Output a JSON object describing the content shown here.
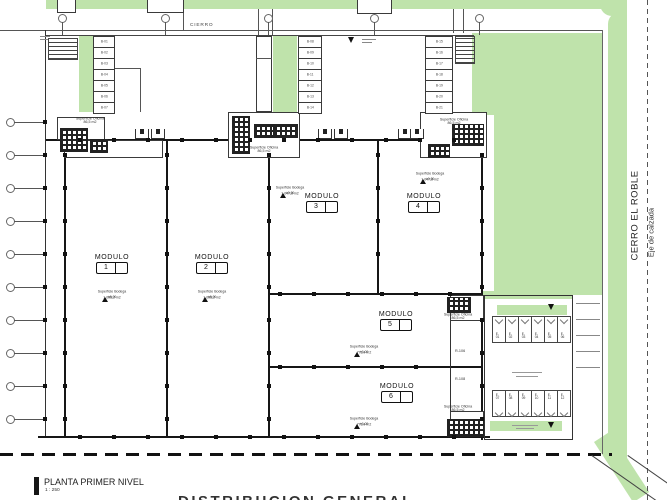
{
  "header": {
    "fence_label": "CIERRO"
  },
  "right_margin": {
    "street": "CERRO EL ROBLE",
    "axis": "Eje de calzada"
  },
  "title_block": {
    "title": "PLANTA PRIMER NIVEL",
    "scale": "1 : 250"
  },
  "footer_title": "DISTRIBUCION GENERAL",
  "levels": {
    "mark": "±0,00"
  },
  "office_label": {
    "line1": "Superficie Oficina",
    "line2": "86,5 m2"
  },
  "modules": [
    {
      "label": "MODULO",
      "num": "1",
      "sup": "Superficie Bodega",
      "area": "1.095,2 m2"
    },
    {
      "label": "MODULO",
      "num": "2",
      "sup": "Superficie Bodega",
      "area": "1.095,2 m2"
    },
    {
      "label": "MODULO",
      "num": "3",
      "sup": "Superficie Bodega",
      "area": "1.047,6 m2"
    },
    {
      "label": "MODULO",
      "num": "4",
      "sup": "Superficie Bodega",
      "area": "1.047,6 m2"
    },
    {
      "label": "MODULO",
      "num": "5",
      "sup": "Superficie Bodega",
      "area": "772,4 m2"
    },
    {
      "label": "MODULO",
      "num": "6",
      "sup": "Superficie Bodega",
      "area": "772,4 m2"
    }
  ],
  "room_stacks": {
    "left": [
      "B-01",
      "B-02",
      "B-03",
      "B-04",
      "B-05",
      "B-06",
      "B-07"
    ],
    "middle": [
      "B-08",
      "B-09",
      "B-10",
      "B-11",
      "B-12",
      "B-13",
      "B-14"
    ],
    "right": [
      "B-15",
      "B-16",
      "B-17",
      "B-18",
      "B-19",
      "B-20",
      "B-21"
    ]
  },
  "parking": {
    "row_top": [
      "E-01",
      "E-02",
      "E-03",
      "E-04",
      "E-05",
      "E-06"
    ],
    "row_bottom": [
      "E-07",
      "E-08",
      "E-09",
      "E-10",
      "E-11",
      "E-12"
    ]
  },
  "ramps": [
    "R-106",
    "R-108"
  ],
  "colors": {
    "green": "#bfe3ab",
    "wall": "#161616"
  }
}
